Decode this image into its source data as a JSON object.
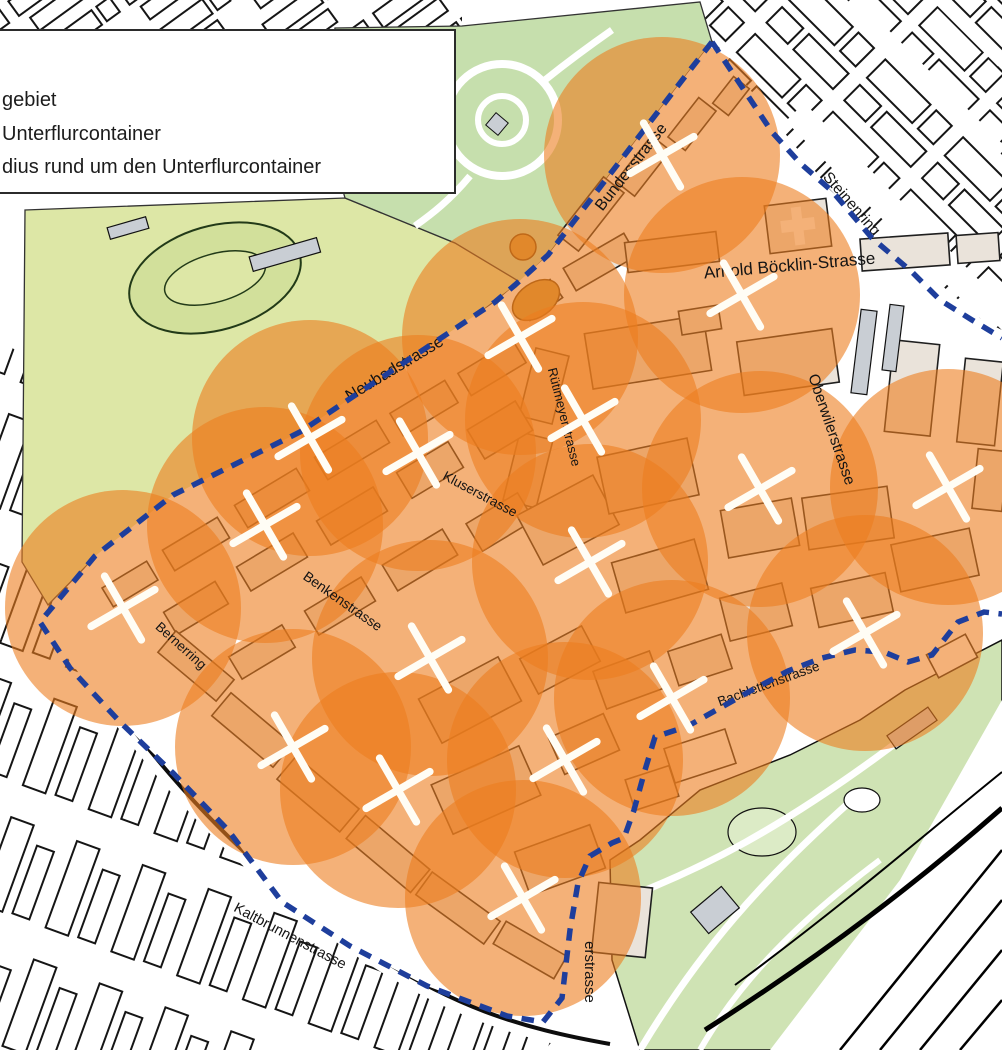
{
  "legend": {
    "items": [
      {
        "label": "gebiet"
      },
      {
        "label": "Unterflurcontainer"
      },
      {
        "label": "dius rund um den Unterflurcontainer"
      }
    ],
    "bg": "#ffffff",
    "border_color": "#2b2b2b"
  },
  "streets": [
    {
      "id": "bundesstrasse",
      "text": "Bundesstrasse"
    },
    {
      "id": "steinenring",
      "text": "Steinenring"
    },
    {
      "id": "arnold-boecklin-strasse",
      "text": "Arnold Böcklin-Strasse"
    },
    {
      "id": "neubadstrasse",
      "text": "Neubadstrasse"
    },
    {
      "id": "ruetimeyerstrasse",
      "text": "Rütimeyerstrasse"
    },
    {
      "id": "oberwilerstrasse",
      "text": "Oberwilerstrasse"
    },
    {
      "id": "kluserstrasse",
      "text": "Kluserstrasse"
    },
    {
      "id": "benkenstrasse",
      "text": "Benkenstrasse"
    },
    {
      "id": "bernerring",
      "text": "Bernerring"
    },
    {
      "id": "bachlettenstrasse",
      "text": "Bachlettenstrasse"
    },
    {
      "id": "kaltbrunnenstrasse",
      "text": "Kaltbrunnenstrasse"
    },
    {
      "id": "erstrasse-fragment",
      "text": "erstrasse"
    }
  ],
  "containers": {
    "radius_px": 118,
    "mark_arm_px": 26,
    "mark_stroke_px": 7.5,
    "mark_rotation_deg": 15,
    "marker_color": "#fffdf5",
    "circle_color": "#ed7d1e",
    "circle_opacity": 0.6,
    "points": [
      {
        "x": 662,
        "y": 155
      },
      {
        "x": 520,
        "y": 337
      },
      {
        "x": 742,
        "y": 295
      },
      {
        "x": 583,
        "y": 420
      },
      {
        "x": 760,
        "y": 489
      },
      {
        "x": 948,
        "y": 487
      },
      {
        "x": 310,
        "y": 438
      },
      {
        "x": 418,
        "y": 453
      },
      {
        "x": 265,
        "y": 525
      },
      {
        "x": 123,
        "y": 608
      },
      {
        "x": 293,
        "y": 747
      },
      {
        "x": 430,
        "y": 658
      },
      {
        "x": 398,
        "y": 790
      },
      {
        "x": 523,
        "y": 898
      },
      {
        "x": 565,
        "y": 760
      },
      {
        "x": 672,
        "y": 698
      },
      {
        "x": 865,
        "y": 633
      },
      {
        "x": 590,
        "y": 562
      }
    ]
  },
  "boundary": {
    "color": "#1e3e9c",
    "dash": "12.5 9.5",
    "width": 5.5
  },
  "colors": {
    "building_outline": "#161616",
    "inside_building_fill": "#eae3da",
    "park_yellow_green": "#dde7a6",
    "park_green": "#c6dfad",
    "zoo_green": "#cfe3b4",
    "gray_building": "#c9ced4",
    "island_tan": "#cf9a3f"
  }
}
